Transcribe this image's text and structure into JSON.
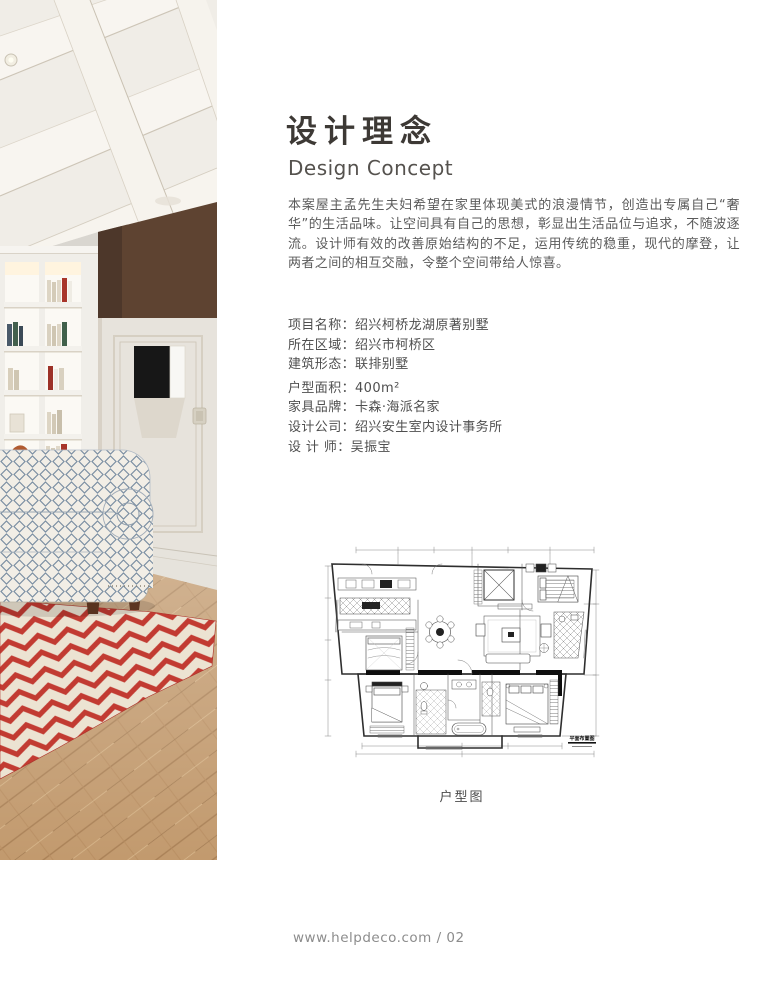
{
  "article": {
    "title_zh": "设计理念",
    "title_en": "Design Concept",
    "paragraph": "本案屋主孟先生夫妇希望在家里体现美式的浪漫情节，创造出专属自己“奢华”的生活品味。让空间具有自己的思想，彰显出生活品位与追求，不随波逐流。设计师有效的改善原始结构的不足，运用传统的稳重，现代的摩登，让两者之间的相互交融，令整个空间带给人惊喜。"
  },
  "project_details": {
    "colon": "：",
    "items": [
      {
        "label": "项目名称",
        "value": "绍兴柯桥龙湖原著别墅"
      },
      {
        "label": "所在区域",
        "value": "绍兴市柯桥区"
      },
      {
        "label": "建筑形态",
        "value": "联排别墅"
      },
      {
        "label": "户型面积",
        "value": "400m²"
      },
      {
        "label": "家具品牌",
        "value": "卡森·海派名家"
      },
      {
        "label": "设计公司",
        "value": "绍兴安生室内设计事务所"
      },
      {
        "label": "设 计 师",
        "value": "吴振宝"
      }
    ]
  },
  "floor_plan": {
    "caption": "户型图",
    "title_block_label": "平面布置图"
  },
  "footer": {
    "text": "www.helpdeco.com / 02"
  },
  "photo": {
    "alt": "American style living room: white coffered ceiling, brown wall panel, white bookshelf, lattice-pattern armchair, red chevron rug, parquet wood floor",
    "colors": {
      "rug_red": "#c23b32",
      "rug_cream": "#ece3d2",
      "wall_panel_brown": "#5e4331",
      "wood_floor": "#c29a6e",
      "chair_pattern_blue": "#7a8ea2"
    }
  }
}
